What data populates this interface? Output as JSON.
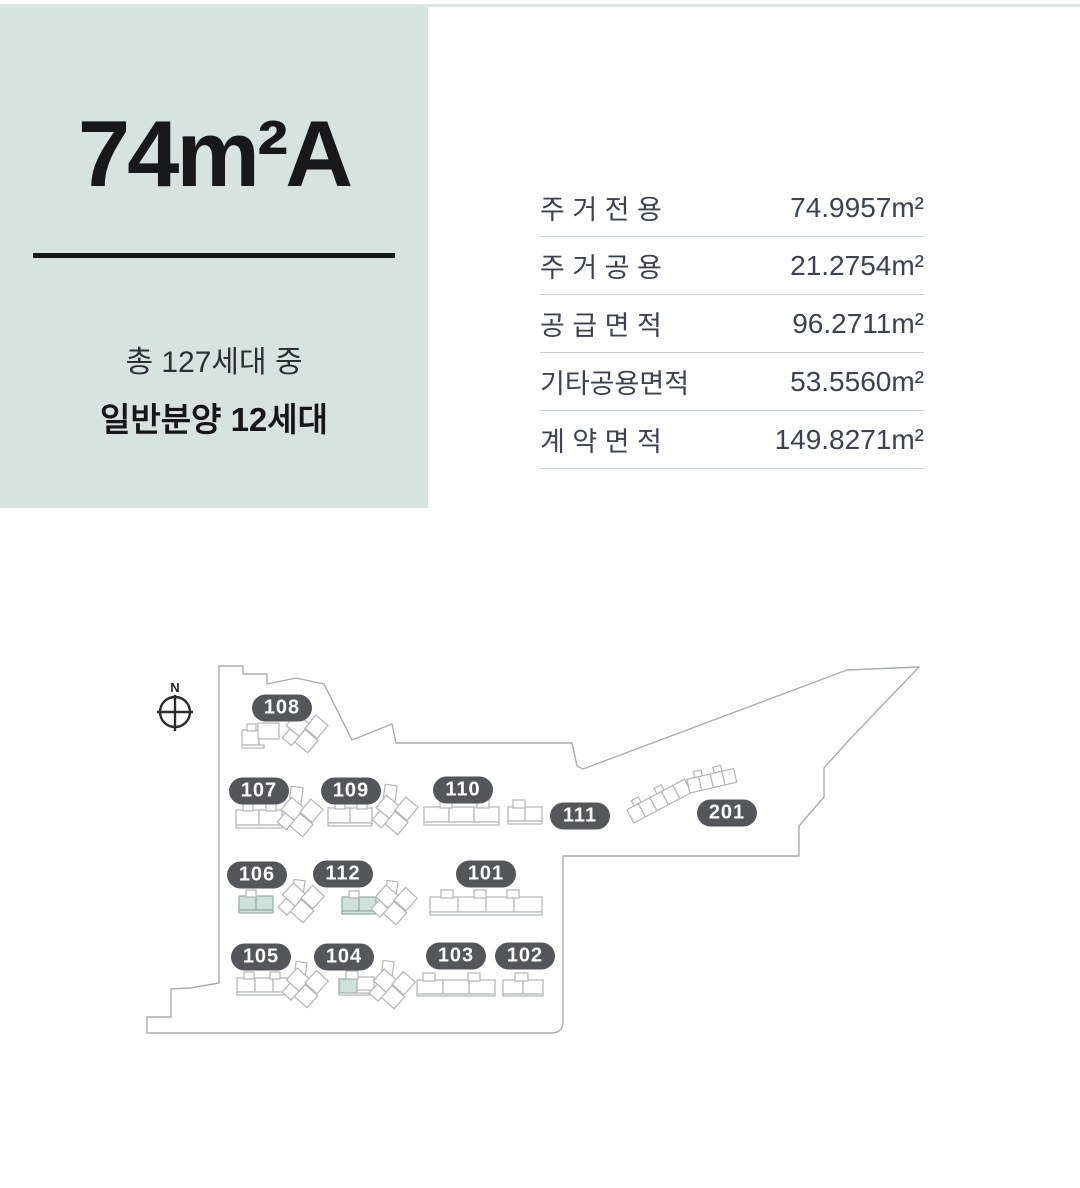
{
  "unit": {
    "title": "74m²A",
    "total_text": "총 127세대 중",
    "sale_text": "일반분양 12세대"
  },
  "area_table": {
    "rows": [
      {
        "label": "주 거 전 용",
        "value": "74.9957m²"
      },
      {
        "label": "주 거 공 용",
        "value": "21.2754m²"
      },
      {
        "label": "공 급 면 적",
        "value": "96.2711m²"
      },
      {
        "label": "기타공용면적",
        "value": "53.5560m²"
      },
      {
        "label": "계 약 면 적",
        "value": "149.8271m²"
      }
    ]
  },
  "map": {
    "compass_label": "N",
    "badges": [
      {
        "label": "108",
        "highlighted": false
      },
      {
        "label": "107",
        "highlighted": false
      },
      {
        "label": "109",
        "highlighted": false
      },
      {
        "label": "110",
        "highlighted": false
      },
      {
        "label": "111",
        "highlighted": false
      },
      {
        "label": "201",
        "highlighted": false
      },
      {
        "label": "106",
        "highlighted": true
      },
      {
        "label": "112",
        "highlighted": true
      },
      {
        "label": "101",
        "highlighted": false
      },
      {
        "label": "105",
        "highlighted": false
      },
      {
        "label": "104",
        "highlighted": true
      },
      {
        "label": "103",
        "highlighted": false
      },
      {
        "label": "102",
        "highlighted": false
      }
    ],
    "highlighted_units": [
      "106",
      "112",
      "104"
    ]
  },
  "theme": {
    "card_bg": "#d6e3df",
    "badge_bg": "#54565a",
    "highlight": "#cfe1db",
    "outline_color": "#a9adab",
    "bld_stroke": "#b2b5b3",
    "separator_color": "#cbd0d5",
    "table_text": "#3c4250",
    "divider_color": "#17181a",
    "title_color": "#17181a"
  }
}
